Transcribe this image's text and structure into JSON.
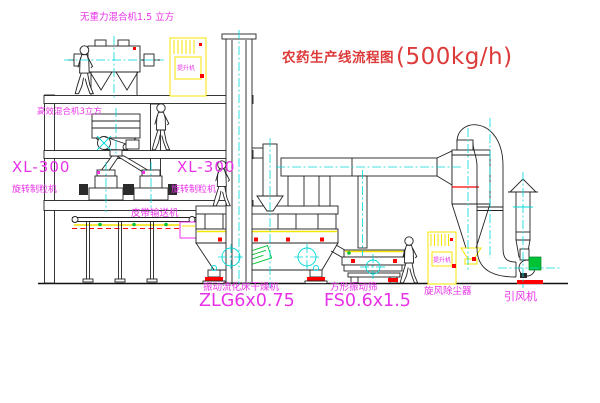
{
  "title": {
    "text": "农药生产线流程图",
    "capacity": "(500kg/h)"
  },
  "equipment_labels": {
    "gravity_mixer": "无重力混合机1.5 立方",
    "high_eff_mixer": "高效混合机3立方",
    "granulator_left_model": "XL-300",
    "granulator_left_name": "旋转制粒机",
    "granulator_right_model": "XL-300",
    "granulator_right_name": "旋转制粒机",
    "belt_conveyor": "皮带输送机",
    "dryer_name": "振动流化床干燥机",
    "dryer_model": "ZLG6x0.75",
    "sieve_name": "方形振动筛",
    "sieve_model": "FS0.6x1.5",
    "cyclone": "旋风除尘器",
    "fan": "引风机",
    "elevator_tag_top": "提升机",
    "elevator_tag_right": "提升机"
  },
  "colors": {
    "background": "#ffffff",
    "line": "#222222",
    "label_magenta": "#e832e8",
    "title_red": "#dd3a3a",
    "centerline_cyan": "#00d8d8",
    "equipment_yellow": "#f7e400",
    "accent_red": "#ff0000",
    "accent_green": "#00c235"
  }
}
